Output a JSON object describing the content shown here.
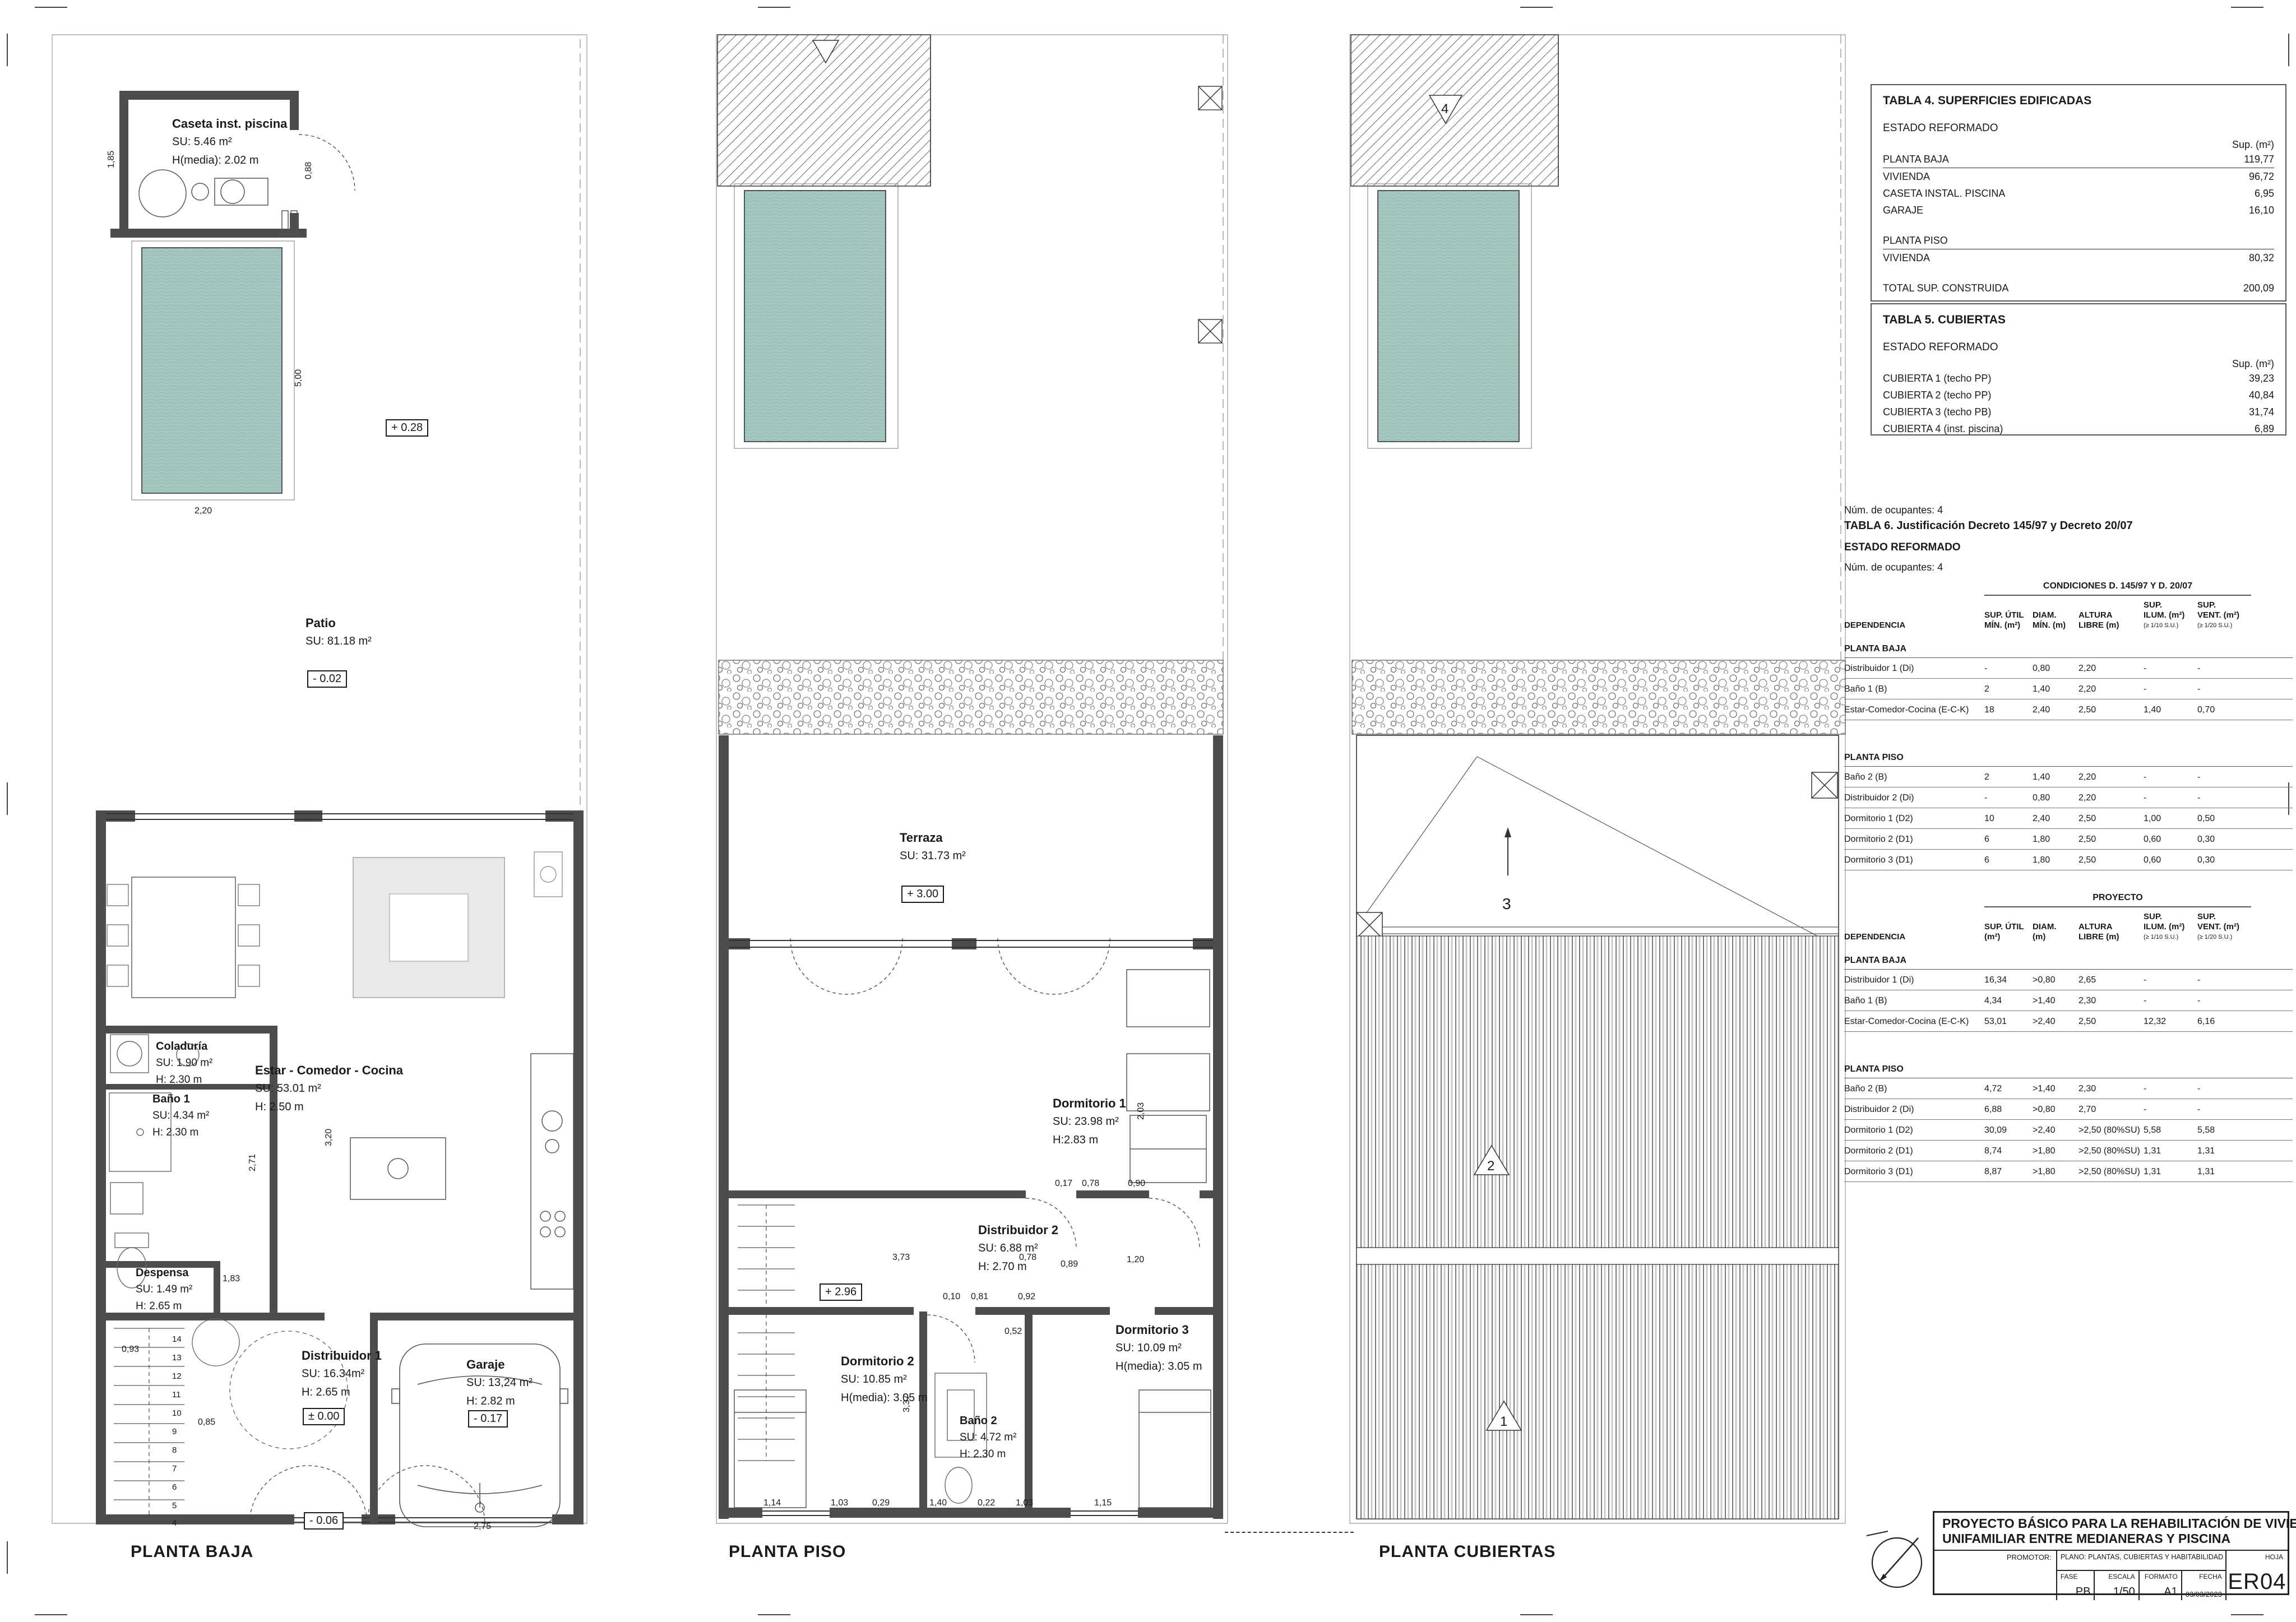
{
  "page": {
    "plan_titles": {
      "pb": "PLANTA BAJA",
      "pp": "PLANTA PISO",
      "pc": "PLANTA CUBIERTAS"
    }
  },
  "plans": {
    "pb": {
      "rooms": {
        "caseta": {
          "name": "Caseta inst. piscina",
          "su": "SU: 5.46 m²",
          "h": "H(media): 2.02 m"
        },
        "patio": {
          "name": "Patio",
          "su": "SU: 81.18 m²"
        },
        "coladuria": {
          "name": "Coladuría",
          "su": "SU: 1.90 m²",
          "h": "H: 2.30 m"
        },
        "bano1": {
          "name": "Baño 1",
          "su": "SU: 4.34 m²",
          "h": "H: 2.30 m"
        },
        "estar": {
          "name": "Estar - Comedor - Cocina",
          "su": "SU: 53.01 m²",
          "h": "H: 2.50 m"
        },
        "despensa": {
          "name": "Despensa",
          "su": "SU: 1.49 m²",
          "h": "H: 2.65 m"
        },
        "distribuidor1": {
          "name": "Distribuidor 1",
          "su": "SU: 16.34m²",
          "h": "H: 2.65 m"
        },
        "garaje": {
          "name": "Garaje",
          "su": "SU: 13,24 m²",
          "h": "H: 2.82 m"
        }
      },
      "levels": {
        "pool": "+ 0.28",
        "patio": "- 0.02",
        "distribuidor": "± 0.00",
        "garaje": "- 0.17",
        "entrada": "- 0.06"
      },
      "dims": {
        "pool_w": "2,20",
        "pool_h": "5,00",
        "caseta": "1,85",
        "caseta_door": "0,88",
        "garage_door": "2,75",
        "stair": "0,93",
        "est1": "2,71",
        "est2": "3,20",
        "hall": "1,83",
        "step": "0,85"
      },
      "stairs": [
        "14",
        "13",
        "12",
        "11",
        "10",
        "9",
        "8",
        "7",
        "6",
        "5",
        "4"
      ]
    },
    "pp": {
      "rooms": {
        "terraza": {
          "name": "Terraza",
          "su": "SU:  31.73 m²"
        },
        "dormitorio1": {
          "name": "Dormitorio 1",
          "su": "SU: 23.98 m²",
          "h": "H:2.83 m"
        },
        "distribuidor2": {
          "name": "Distribuidor 2",
          "su": "SU: 6.88 m²",
          "h": "H: 2.70 m"
        },
        "dormitorio2": {
          "name": "Dormitorio 2",
          "su": "SU: 10.85 m²",
          "h": "H(media): 3.05 m"
        },
        "bano2": {
          "name": "Baño 2",
          "su": "SU: 4.72 m²",
          "h": "H: 2.30 m"
        },
        "dormitorio3": {
          "name": "Dormitorio 3",
          "su": "SU: 10.09 m²",
          "h": "H(media): 3.05 m"
        }
      },
      "levels": {
        "terraza": "+ 3.00",
        "distribuidor": "+ 2.96"
      },
      "dims": {
        "d1": "3,73",
        "d2": "0,78",
        "d3": "0,89",
        "d4": "1,20",
        "d5": "0,10",
        "d6": "0,81",
        "d7": "0,92",
        "d8": "0,52",
        "d9": "2,03",
        "d10": "0,17",
        "d11": "0,78",
        "d12": "0,90",
        "s1": "3,37",
        "b1": "1,14",
        "b2": "1,03",
        "b3": "0,29",
        "b4": "1,40",
        "b5": "0,22",
        "b6": "1,03",
        "b7": "1,15"
      }
    },
    "pc": {
      "marks": {
        "m1": "1",
        "m2": "2",
        "m3": "3",
        "m4": "4"
      }
    }
  },
  "tables": {
    "t4": {
      "title": "TABLA 4. SUPERFICIES EDIFICADAS",
      "state": "ESTADO REFORMADO",
      "unit": "Sup. (m²)",
      "rows": {
        "r0": {
          "label": "PLANTA BAJA",
          "value": "119,77"
        },
        "r1": {
          "label": "VIVIENDA",
          "value": "96,72"
        },
        "r2": {
          "label": "CASETA INSTAL. PISCINA",
          "value": "6,95"
        },
        "r3": {
          "label": "GARAJE",
          "value": "16,10"
        },
        "r4": {
          "label": "PLANTA PISO",
          "value": ""
        },
        "r5": {
          "label": "VIVIENDA",
          "value": "80,32"
        },
        "r6": {
          "label": "TOTAL SUP. CONSTRUIDA",
          "value": "200,09"
        }
      }
    },
    "t5": {
      "title": "TABLA 5. CUBIERTAS",
      "state": "ESTADO REFORMADO",
      "unit": "Sup. (m²)",
      "rows": [
        {
          "label": "CUBIERTA 1 (techo PP)",
          "value": "39,23"
        },
        {
          "label": "CUBIERTA 2 (techo PP)",
          "value": "40,84"
        },
        {
          "label": "CUBIERTA 3 (techo PB)",
          "value": "31,74"
        },
        {
          "label": "CUBIERTA 4 (inst. piscina)",
          "value": "6,89"
        }
      ]
    },
    "t6": {
      "occupants_top": "Núm. de ocupantes:  4",
      "title": "TABLA 6. Justificación Decreto 145/97 y Decreto 20/07",
      "state": "ESTADO REFORMADO",
      "occupants": "Núm. de ocupantes:  4",
      "dep_header": "DEPENDENCIA",
      "section_pb": "PLANTA BAJA",
      "section_pp": "PLANTA PISO",
      "cond": {
        "group": "CONDICIONES D. 145/97 Y D. 20/07",
        "cols": [
          "SUP. ÚTIL\nMÍN. (m²)",
          "DIAM.\nMÍN. (m)",
          "ALTURA\nLIBRE (m)",
          "SUP.\nILUM. (m²)",
          "SUP.\nVENT. (m²)"
        ],
        "notes": [
          "",
          "",
          "",
          "(≥ 1/10 S.U.)",
          "(≥ 1/20 S.U.)"
        ],
        "pb_rows": [
          [
            "Distribuidor 1 (Di)",
            "-",
            "0,80",
            "2,20",
            "-",
            "-"
          ],
          [
            "Baño 1 (B)",
            "2",
            "1,40",
            "2,20",
            "-",
            "-"
          ],
          [
            "Estar-Comedor-Cocina (E-C-K)",
            "18",
            "2,40",
            "2,50",
            "1,40",
            "0,70"
          ]
        ],
        "pp_rows": [
          [
            "Baño 2 (B)",
            "2",
            "1,40",
            "2,20",
            "-",
            "-"
          ],
          [
            "Distribuidor 2 (Di)",
            "-",
            "0,80",
            "2,20",
            "-",
            "-"
          ],
          [
            "Dormitorio 1 (D2)",
            "10",
            "2,40",
            "2,50",
            "1,00",
            "0,50"
          ],
          [
            "Dormitorio 2 (D1)",
            "6",
            "1,80",
            "2,50",
            "0,60",
            "0,30"
          ],
          [
            "Dormitorio 3 (D1)",
            "6",
            "1,80",
            "2,50",
            "0,60",
            "0,30"
          ]
        ]
      },
      "proy": {
        "group": "PROYECTO",
        "cols": [
          "SUP. ÚTIL\n(m²)",
          "DIAM.\n(m)",
          "ALTURA\nLIBRE (m)",
          "SUP.\nILUM. (m²)",
          "SUP.\nVENT. (m²)"
        ],
        "notes": [
          "",
          "",
          "",
          "(≥ 1/10 S.U.)",
          "(≥ 1/20 S.U.)"
        ],
        "pb_rows": [
          [
            "Distribuidor 1 (Di)",
            "16,34",
            ">0,80",
            "2,65",
            "-",
            "-"
          ],
          [
            "Baño 1 (B)",
            "4,34",
            ">1,40",
            "2,30",
            "-",
            "-"
          ],
          [
            "Estar-Comedor-Cocina (E-C-K)",
            "53,01",
            ">2,40",
            "2,50",
            "12,32",
            "6,16"
          ]
        ],
        "pp_rows": [
          [
            "Baño 2 (B)",
            "4,72",
            ">1,40",
            "2,30",
            "-",
            "-"
          ],
          [
            "Distribuidor 2 (Di)",
            "6,88",
            ">0,80",
            "2,70",
            "-",
            "-"
          ],
          [
            "Dormitorio 1 (D2)",
            "30,09",
            ">2,40",
            ">2,50 (80%SU)",
            "5,58",
            "5,58"
          ],
          [
            "Dormitorio 2 (D1)",
            "8,74",
            ">1,80",
            ">2,50 (80%SU)",
            "1,31",
            "1,31"
          ],
          [
            "Dormitorio 3 (D1)",
            "8,87",
            ">1,80",
            ">2,50 (80%SU)",
            "1,31",
            "1,31"
          ]
        ]
      }
    }
  },
  "titleblock": {
    "title1": "PROYECTO BÁSICO PARA LA REHABILITACIÓN DE VIVIENDA",
    "title2": "UNIFAMILIAR ENTRE MEDIANERAS Y PISCINA",
    "promotor": "PROMOTOR:",
    "plano": "PLANO: PLANTAS, CUBIERTAS Y HABITABILIDAD   E. REFORMADO",
    "hoja": "HOJA",
    "fase_label": "FASE",
    "fase": "PB",
    "escala_label": "ESCALA",
    "escala": "1/50",
    "formato_label": "FORMATO",
    "formato": "A1",
    "fecha_label": "FECHA",
    "fecha": "03/03/2023",
    "code": "ER04"
  }
}
